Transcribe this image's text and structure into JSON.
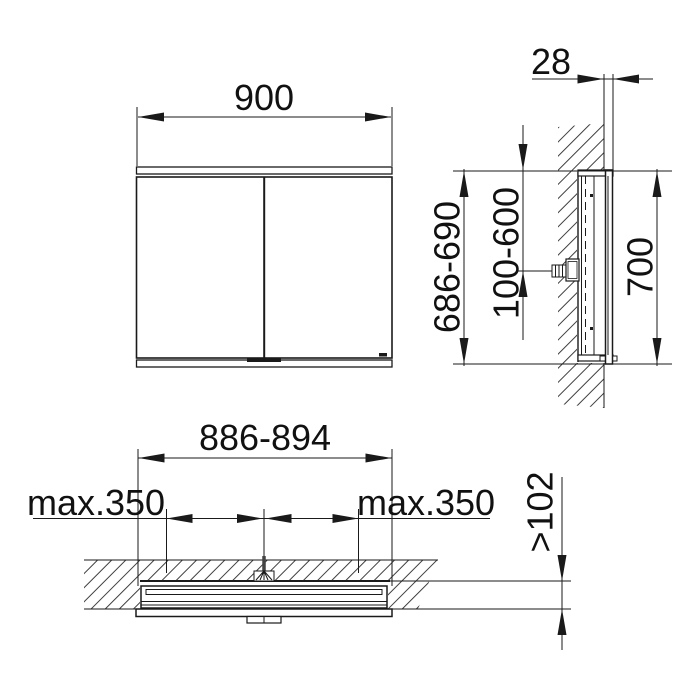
{
  "drawing": {
    "background": "#ffffff",
    "line_color": "#1a1a1a",
    "front_view": {
      "width": "900"
    },
    "side_view": {
      "protrusion_depth": "28",
      "recess_height": "686-690",
      "connection_range": "100-600",
      "cabinet_height": "700"
    },
    "plan_view": {
      "recess_width": "886-894",
      "max_left": "max.350",
      "max_right": "max.350",
      "min_recess_depth": ">102"
    }
  }
}
